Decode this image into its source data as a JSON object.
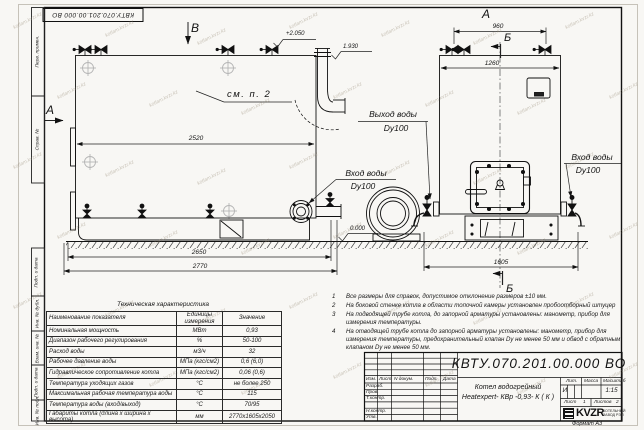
{
  "watermark": {
    "text": "kotlam.kvzr.kz"
  },
  "stamp_top": "КВТУ.070.201.00.000  ВО",
  "frame": {
    "left_top_labels": [
      "Перв. примен.",
      "Справ. №"
    ],
    "left_bottom_labels": [
      "Подп. и дата",
      "Инв. № дубл.",
      "Взам. инв. №",
      "Подп. и дата",
      "Инв. № подл."
    ]
  },
  "views": {
    "label_b_top": "В",
    "label_a_left": "А",
    "label_a_right": "А",
    "label_b_sect_top": "Б",
    "label_b_sect_bottom": "Б",
    "see_note": "см. п. 2",
    "elev_top": "+2.050",
    "elev_pipe": "1.930",
    "elev_zero": "0.000"
  },
  "dims": {
    "d2520": "2520",
    "d2650": "2650",
    "d2770": "2770",
    "d960": "960",
    "d1260": "1260",
    "d1605": "1605"
  },
  "callouts": {
    "outlet_line1": "Выход воды",
    "outlet_line2": "Dy100",
    "inlet_left_line1": "Вход воды",
    "inlet_left_line2": "Dy100",
    "inlet_right_line1": "Вход воды",
    "inlet_right_line2": "Dy100"
  },
  "tech_table": {
    "title": "Техническая характеристика",
    "headers": [
      "Наименование показателя",
      "Единицы измерения",
      "Значение"
    ],
    "rows": [
      [
        "Номинальная мощность",
        "МВт",
        "0,93"
      ],
      [
        "Диапазон рабочего регулирования",
        "%",
        "50-100"
      ],
      [
        "Расход воды",
        "м3/ч",
        "32"
      ],
      [
        "Рабочее давление воды",
        "МПа (кгс/см2)",
        "0,6 (6,0)"
      ],
      [
        "Гидравлическое сопротивление котла",
        "МПа (кгс/см2)",
        "0,06 (0,6)"
      ],
      [
        "Температура уходящих газов",
        "°С",
        "не более 250"
      ],
      [
        "Максимальная рабочая температура воды",
        "°С",
        "115"
      ],
      [
        "Температура воды (вход/выход)",
        "°С",
        "70/95"
      ],
      [
        "Габариты котла (длина х ширина х высота)",
        "мм",
        "2770х1605х2050"
      ]
    ]
  },
  "notes": [
    {
      "num": "1",
      "text": "Все размеры для справок, допустимое отклонение размеров ±10 мм."
    },
    {
      "num": "2",
      "text": "На боковой стенке котла в области топочной камеры установлен пробоотборный штуцер"
    },
    {
      "num": "3",
      "text": "На подводящей трубе котла, до запорной арматуры установлены: манометр, прибор для измерения температуры."
    },
    {
      "num": "4",
      "text": "На отводящей трубе котла до запорной арматуры установлены: манометр, прибор для измерения температуры, предохранительный клапан Dу не менее 50 мм и обвод с обратным клапаном Dу не менее 50 мм."
    }
  ],
  "title_block": {
    "doc_number": "КВТУ.070.201.00.000  ВО",
    "title_line1": "Котел водогрейный",
    "title_line2": "Heatexpert- КВр -0,93- К ( К )",
    "header_cols": [
      "Изм.",
      "Лист",
      "N докум.",
      "Подп.",
      "Дата"
    ],
    "sig_rows": [
      "Разраб.",
      "Пров.",
      "Т.контр.",
      "",
      "Н.контр.",
      "Утв."
    ],
    "lit_label": "Лит.",
    "lit_value": "И",
    "mass_label": "Масса",
    "scale_label": "Масштаб",
    "scale_value": "1:15",
    "sheet_label": "Лист",
    "sheet_value": "1",
    "sheets_label": "Листов",
    "sheets_value": "2",
    "logo_text": "KVZR",
    "logo_sub1": "КОТЕЛЬНЫЙ",
    "logo_sub2": "ЗАВОД РЭП",
    "format_label": "Формат  А3"
  }
}
